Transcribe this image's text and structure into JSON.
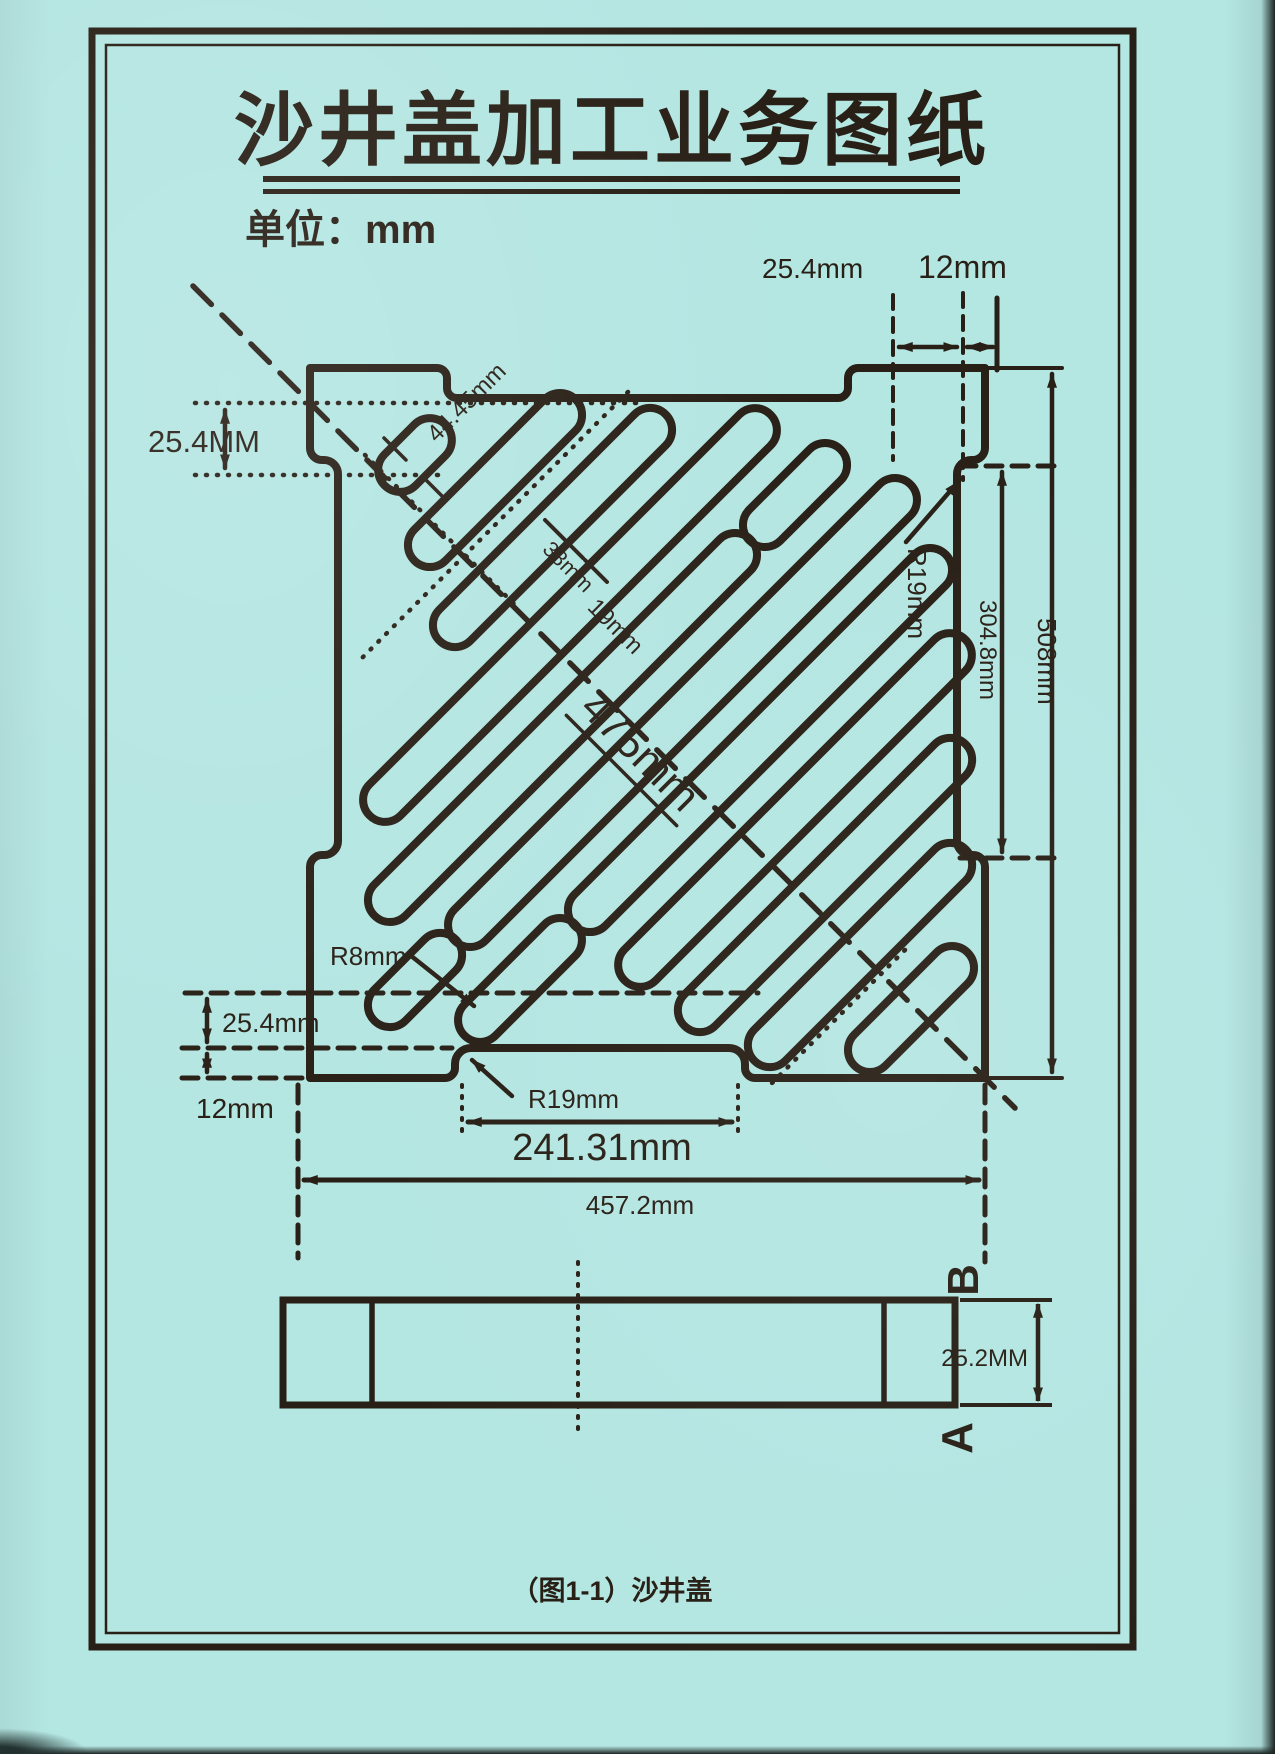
{
  "page": {
    "title": "沙井盖加工业务图纸",
    "unit_label": "单位：mm",
    "caption": "（图1-1）沙井盖"
  },
  "colors": {
    "paper": "#b4e6e2",
    "ink": "#281f16"
  },
  "dims": {
    "top_left_offset": "25.4MM",
    "top_right_inset": "25.4mm",
    "top_right_edge": "12mm",
    "corner_slot_offset": "44.45mm",
    "slot_width": "38mm",
    "slot_gap": "19mm",
    "slot_length": "475mm",
    "slot_end_radius": "R8mm",
    "side_notch_radius": "R19mm",
    "side_notch_length": "304.8mm",
    "overall_height": "508mm",
    "bottom_offset": "25.4mm",
    "bottom_edge": "12mm",
    "bottom_notch_radius": "R19mm",
    "bottom_notch_width": "241.31mm",
    "overall_width": "457.2mm"
  },
  "section": {
    "label_top": "B",
    "label_bottom": "A",
    "thickness": "25.2MM"
  }
}
